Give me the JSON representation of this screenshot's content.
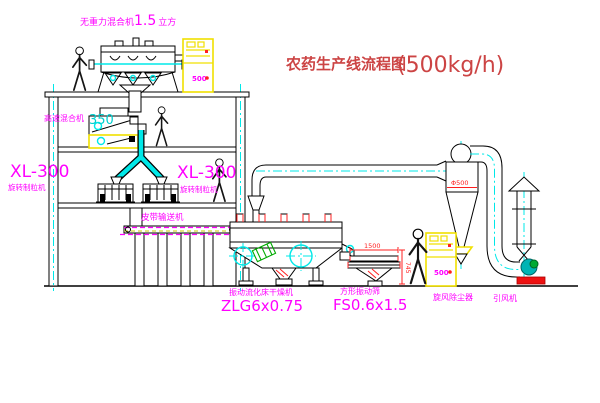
{
  "title": {
    "text_cn": "农药生产线流程图",
    "capacity": "(500kg/h)"
  },
  "equipment": {
    "gravity_mixer": {
      "label": "无重力混合机",
      "size": "1.5",
      "unit": "立方"
    },
    "high_speed_mixer": {
      "label": "高速混合机",
      "model": "350"
    },
    "granulator_left": {
      "model": "XL-300",
      "label": "旋转制粒机"
    },
    "granulator_right": {
      "model": "XL-300",
      "label": "旋转制粒机"
    },
    "belt_conveyor": {
      "label": "皮带输送机"
    },
    "fluid_bed_dryer": {
      "label": "振动流化床干燥机",
      "model": "ZLG6x0.75"
    },
    "vibrating_sieve": {
      "label": "方形振动筛",
      "model": "FS0.6x1.5"
    },
    "cyclone": {
      "label": "旋风除尘器"
    },
    "induced_draft_fan": {
      "label": "引风机"
    },
    "control_cabinet_1": {
      "display": "500"
    },
    "control_cabinet_2": {
      "display": "500"
    }
  },
  "dimensions": {
    "cyclone_diameter": "Φ500",
    "sieve_length": "1500",
    "sieve_height": "745"
  },
  "colors": {
    "line": "#000000",
    "centerline_cyan": "#00e8e8",
    "label_magenta": "#ff00ff",
    "title_red": "#cc4444",
    "dimension_red": "#ff2020",
    "highlight_yellow": "#f0e000",
    "fan_teal": "#00b4b4",
    "hatch_green": "#00aa00"
  }
}
